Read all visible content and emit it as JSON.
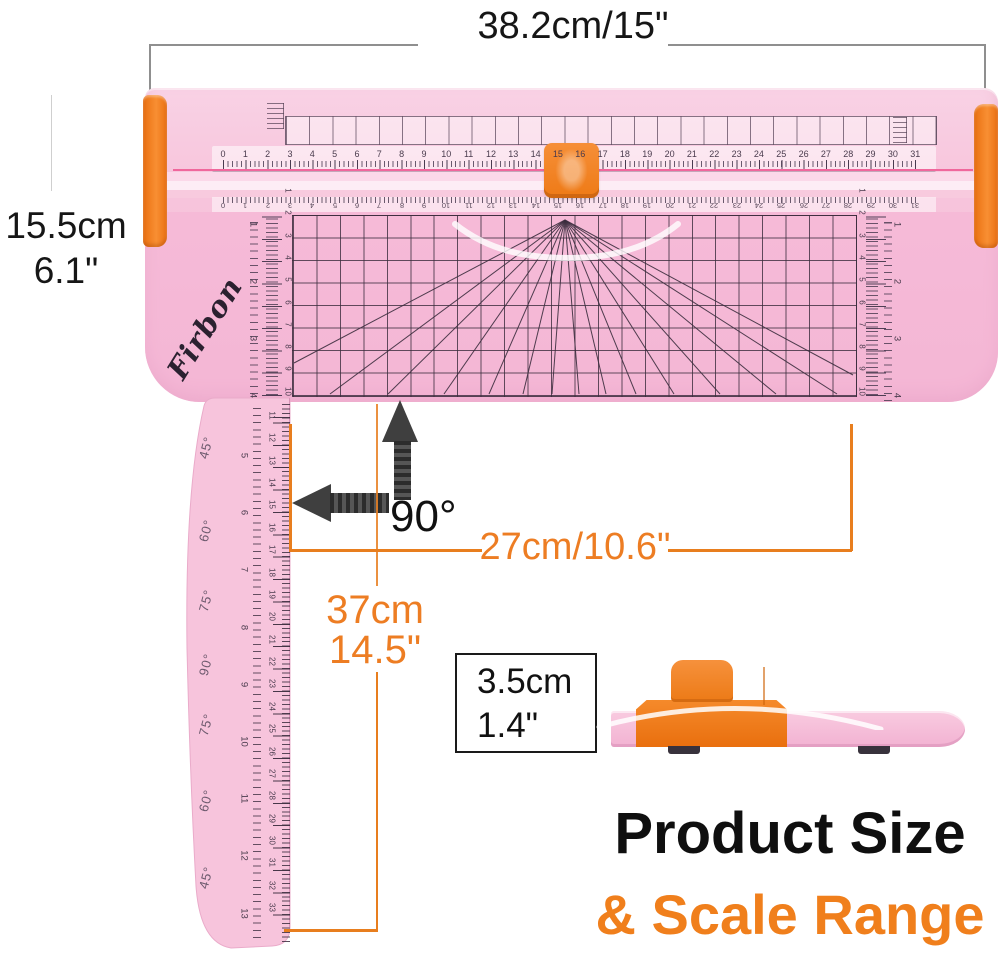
{
  "colors": {
    "accent_orange": "#E87E1E",
    "title_orange": "#F07F1C",
    "product_pink": "#F7C3DA",
    "product_orange": "#F5821F",
    "grid_line": "#3A2C3C",
    "dim_gray": "#8F8F8F",
    "text_black": "#1A1A1A"
  },
  "labels": {
    "width": "38.2cm/15\"",
    "height_cm": "15.5cm",
    "height_in": "6.1\"",
    "angle": "90°",
    "cut_width": "27cm/10.6\"",
    "arm_cm": "37cm",
    "arm_in": "14.5\"",
    "thickness_cm": "3.5cm",
    "thickness_in": "1.4\"",
    "title_black": "Product Size",
    "title_orange": "& Scale Range"
  },
  "trimmer": {
    "brand": "Firbon",
    "top_ruler_cm": [
      "0",
      "1",
      "2",
      "3",
      "4",
      "5",
      "6",
      "7",
      "8",
      "9",
      "10",
      "11",
      "12",
      "13",
      "14",
      "15",
      "16",
      "17",
      "18",
      "19",
      "20",
      "21",
      "22",
      "23",
      "24",
      "25",
      "26",
      "27",
      "28",
      "29",
      "30",
      "31"
    ],
    "side_scale_cm": [
      "1",
      "2",
      "3",
      "4",
      "5",
      "6",
      "7",
      "8",
      "9",
      "10"
    ],
    "side_scale_in": [
      "1",
      "2",
      "3",
      "4"
    ]
  },
  "swing_arm": {
    "angle_labels": [
      "45°",
      "60°",
      "75°",
      "90°",
      "75°",
      "60°",
      "45°"
    ],
    "scale_cm": [
      "11",
      "12",
      "13",
      "14",
      "15",
      "16",
      "17",
      "18",
      "19",
      "20",
      "21",
      "22",
      "23",
      "24",
      "25",
      "26",
      "27",
      "28",
      "29",
      "30",
      "31",
      "32",
      "33"
    ],
    "scale_in": [
      "5",
      "6",
      "7",
      "8",
      "9",
      "10",
      "11",
      "12",
      "13"
    ]
  }
}
